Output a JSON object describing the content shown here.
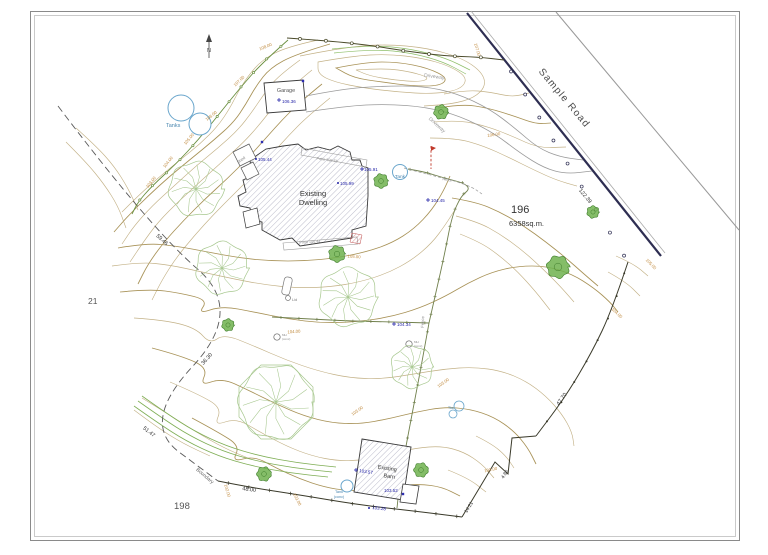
{
  "texts": {
    "sample_road": "Sample Road",
    "lot_number": "196",
    "lot_area": "6358sq.m.",
    "adjacent_lot_west": "21",
    "adjacent_lot_south": "198",
    "north": "N",
    "garage": "Garage",
    "shed": "Shed",
    "dwelling_line1": "Existing",
    "dwelling_line2": "Dwelling",
    "barn_line1": "Existing",
    "barn_line2": "Barn",
    "tanks": "Tanks",
    "tank": "Tank",
    "tank_small_line1": "Tank",
    "tank_small_line2": "(conc)",
    "tks": "Tks",
    "lid": "Lid",
    "mh": "MH",
    "mh_conc": "(conc)",
    "fence": "Fence",
    "boundary": "Boundary",
    "driveway": "Driveway",
    "patio_upper": "Patio 105.56",
    "patio_lower": "Patio 105.41",
    "dim_road": "122.39",
    "dim_east": "47.70",
    "dim_jog": "4.86",
    "dim_se": "14.21",
    "dim_south": "48.00",
    "dim_sw": "51.47",
    "dim_west_lower": "36.30",
    "dim_west_upper": "59.46",
    "spot_garage": "106.36",
    "spot_105_44": "105.44",
    "spot_105_91": "105.91",
    "spot_105_99": "105.99",
    "spot_104_45": "104.45",
    "spot_104_34": "104.34",
    "spot_103_57": "103.57",
    "spot_103_52": "103.52",
    "spot_103_28": "103.28",
    "contour_108": "108.00",
    "contour_107": "107.00",
    "contour_106": "106.00",
    "contour_105": "105.00",
    "contour_104": "104.00",
    "contour_103": "103.00",
    "contour_102": "102.00"
  },
  "colors": {
    "contour_label": "#c08a3e",
    "contour_line": "#c3b186",
    "contour_index": "#a89257",
    "spot_level": "#2525a8",
    "water_feature": "#6aa6cc",
    "tree_light": "#a6c78d",
    "tree_dark": "#5fae46",
    "road_edge": "#2e2e52",
    "fence_green": "#6a8f3f",
    "fence_olive": "#71804d"
  }
}
